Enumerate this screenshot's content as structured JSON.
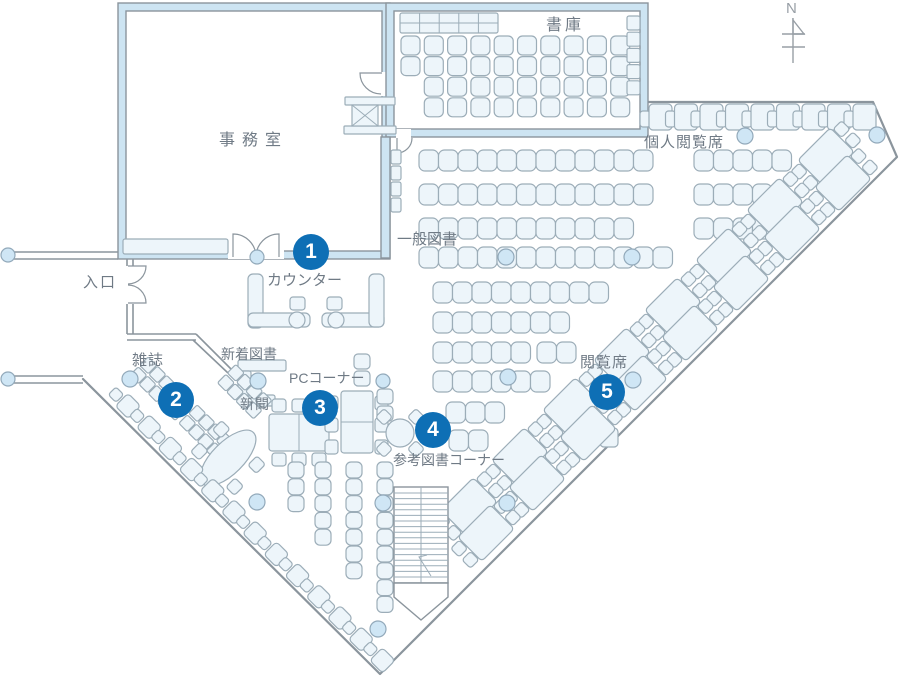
{
  "colors": {
    "wall": "#8b959d",
    "wall_glass": "#cde4f2",
    "furniture_stroke": "#9cadb8",
    "furniture_fill": "#edf5fa",
    "column_fill": "#cfe6f5",
    "column_stroke": "#92a9ba",
    "marker_blue": "#0e6fb5",
    "marker_text": "#ffffff",
    "label_text": "#6f7a85",
    "north": "#989fa6"
  },
  "north": {
    "label": "N"
  },
  "labels": {
    "stacks": "書庫",
    "office": "事務室",
    "individual_seats": "個人閲覧席",
    "general_books": "一般図書",
    "entrance": "入口",
    "counter": "カウンター",
    "magazines": "雑誌",
    "new_arrivals": "新着図書",
    "newspaper": "新聞",
    "pc_corner": "PCコーナー",
    "reference_corner": "参考図書コーナー",
    "reading_seats": "閲覧席"
  },
  "markers": [
    {
      "number": "1"
    },
    {
      "number": "2"
    },
    {
      "number": "3"
    },
    {
      "number": "4"
    },
    {
      "number": "5"
    }
  ]
}
